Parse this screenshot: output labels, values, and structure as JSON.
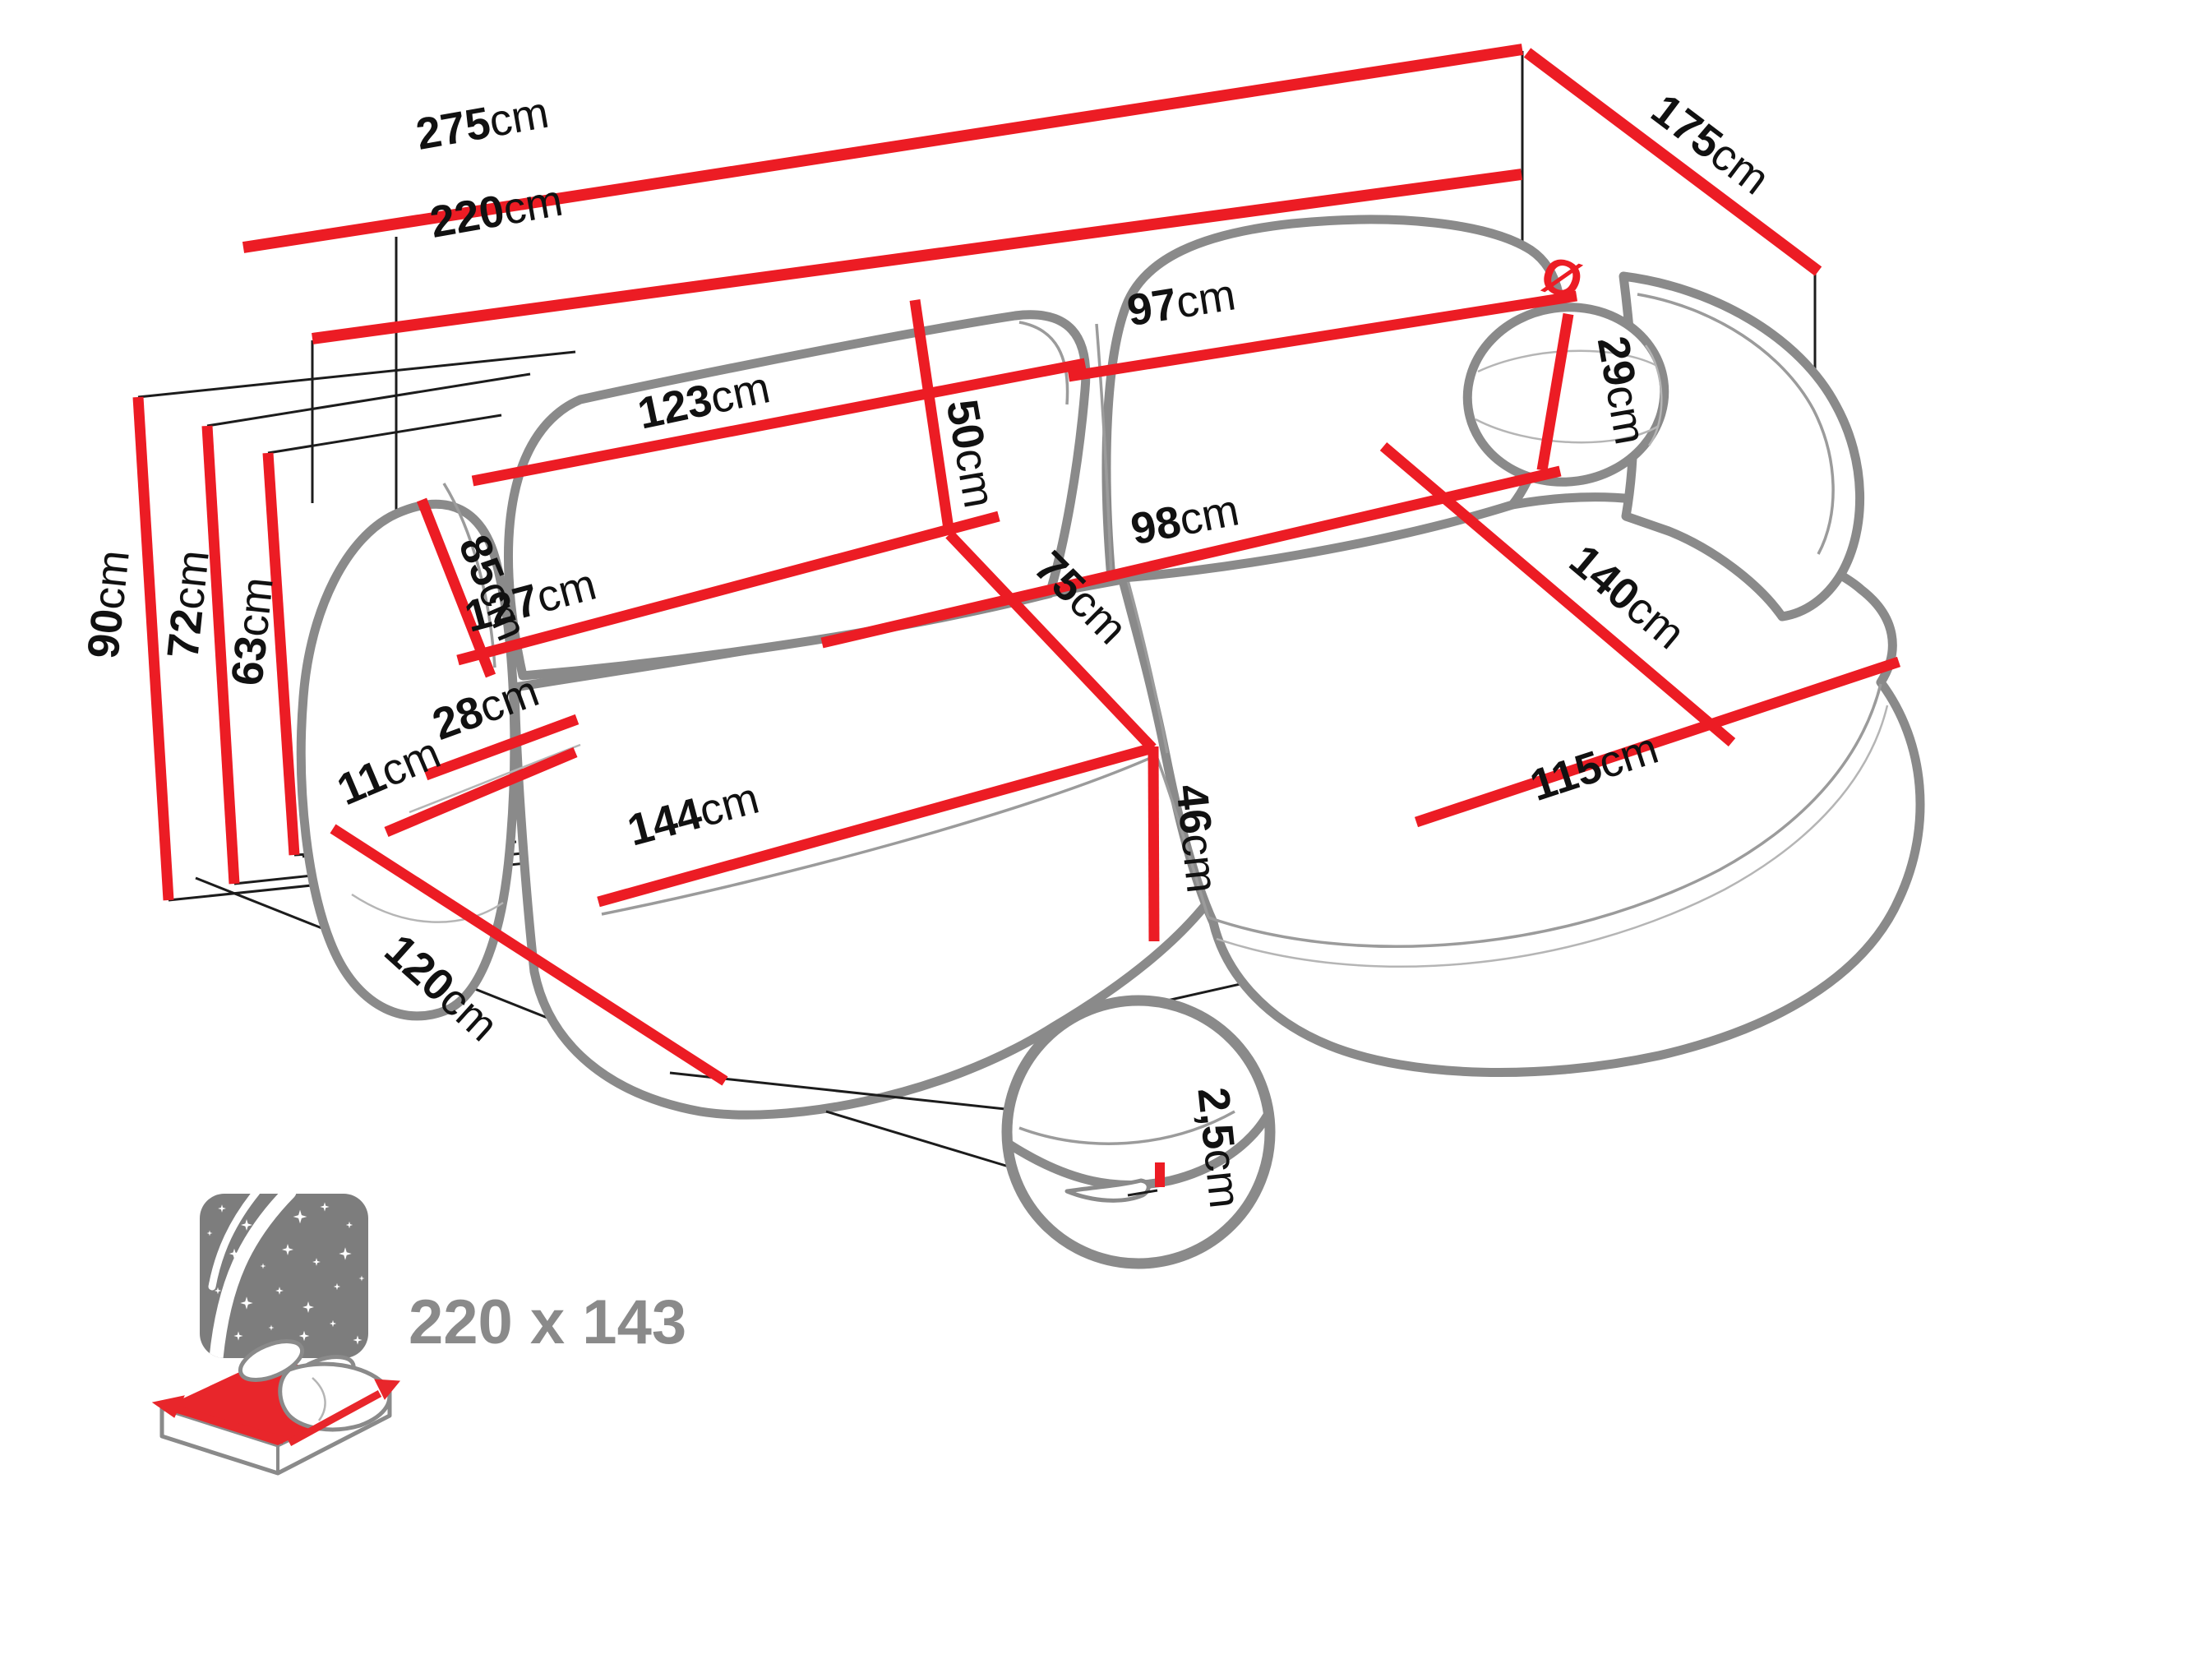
{
  "dims": {
    "d275": {
      "v": "275",
      "u": "cm"
    },
    "d220": {
      "v": "220",
      "u": "cm"
    },
    "d175": {
      "v": "175",
      "u": "cm"
    },
    "d90": {
      "v": "90",
      "u": "cm"
    },
    "d72": {
      "v": "72",
      "u": "cm"
    },
    "d63": {
      "v": "63",
      "u": "cm"
    },
    "d123": {
      "v": "123",
      "u": "cm"
    },
    "d50": {
      "v": "50",
      "u": "cm"
    },
    "d97": {
      "v": "97",
      "u": "cm"
    },
    "d29": {
      "p": "Ø",
      "v": "29",
      "u": "cm"
    },
    "d85": {
      "v": "85",
      "u": "cm"
    },
    "d28": {
      "v": "28",
      "u": "cm"
    },
    "d127": {
      "v": "127",
      "u": "cm"
    },
    "d75": {
      "v": "75",
      "u": "cm"
    },
    "d98": {
      "v": "98",
      "u": "cm"
    },
    "d140": {
      "v": "140",
      "u": "cm"
    },
    "d115": {
      "v": "115",
      "u": "cm"
    },
    "d144": {
      "v": "144",
      "u": "cm"
    },
    "d46": {
      "v": "46",
      "u": "cm"
    },
    "d11": {
      "v": "11",
      "u": "cm"
    },
    "d120": {
      "v": "120",
      "u": "cm"
    },
    "d2_5": {
      "v": "2,5",
      "u": "cm"
    }
  },
  "sleeping_area": {
    "dimensions": "220 x 143"
  },
  "colors": {
    "dimension_red": "#ec1c24",
    "outline_gray": "#8a8a8a",
    "line_black": "#1c1c1c",
    "label_black": "#111111",
    "icon_gray": "#7d7d7d",
    "mattress_red": "#e8262b"
  }
}
